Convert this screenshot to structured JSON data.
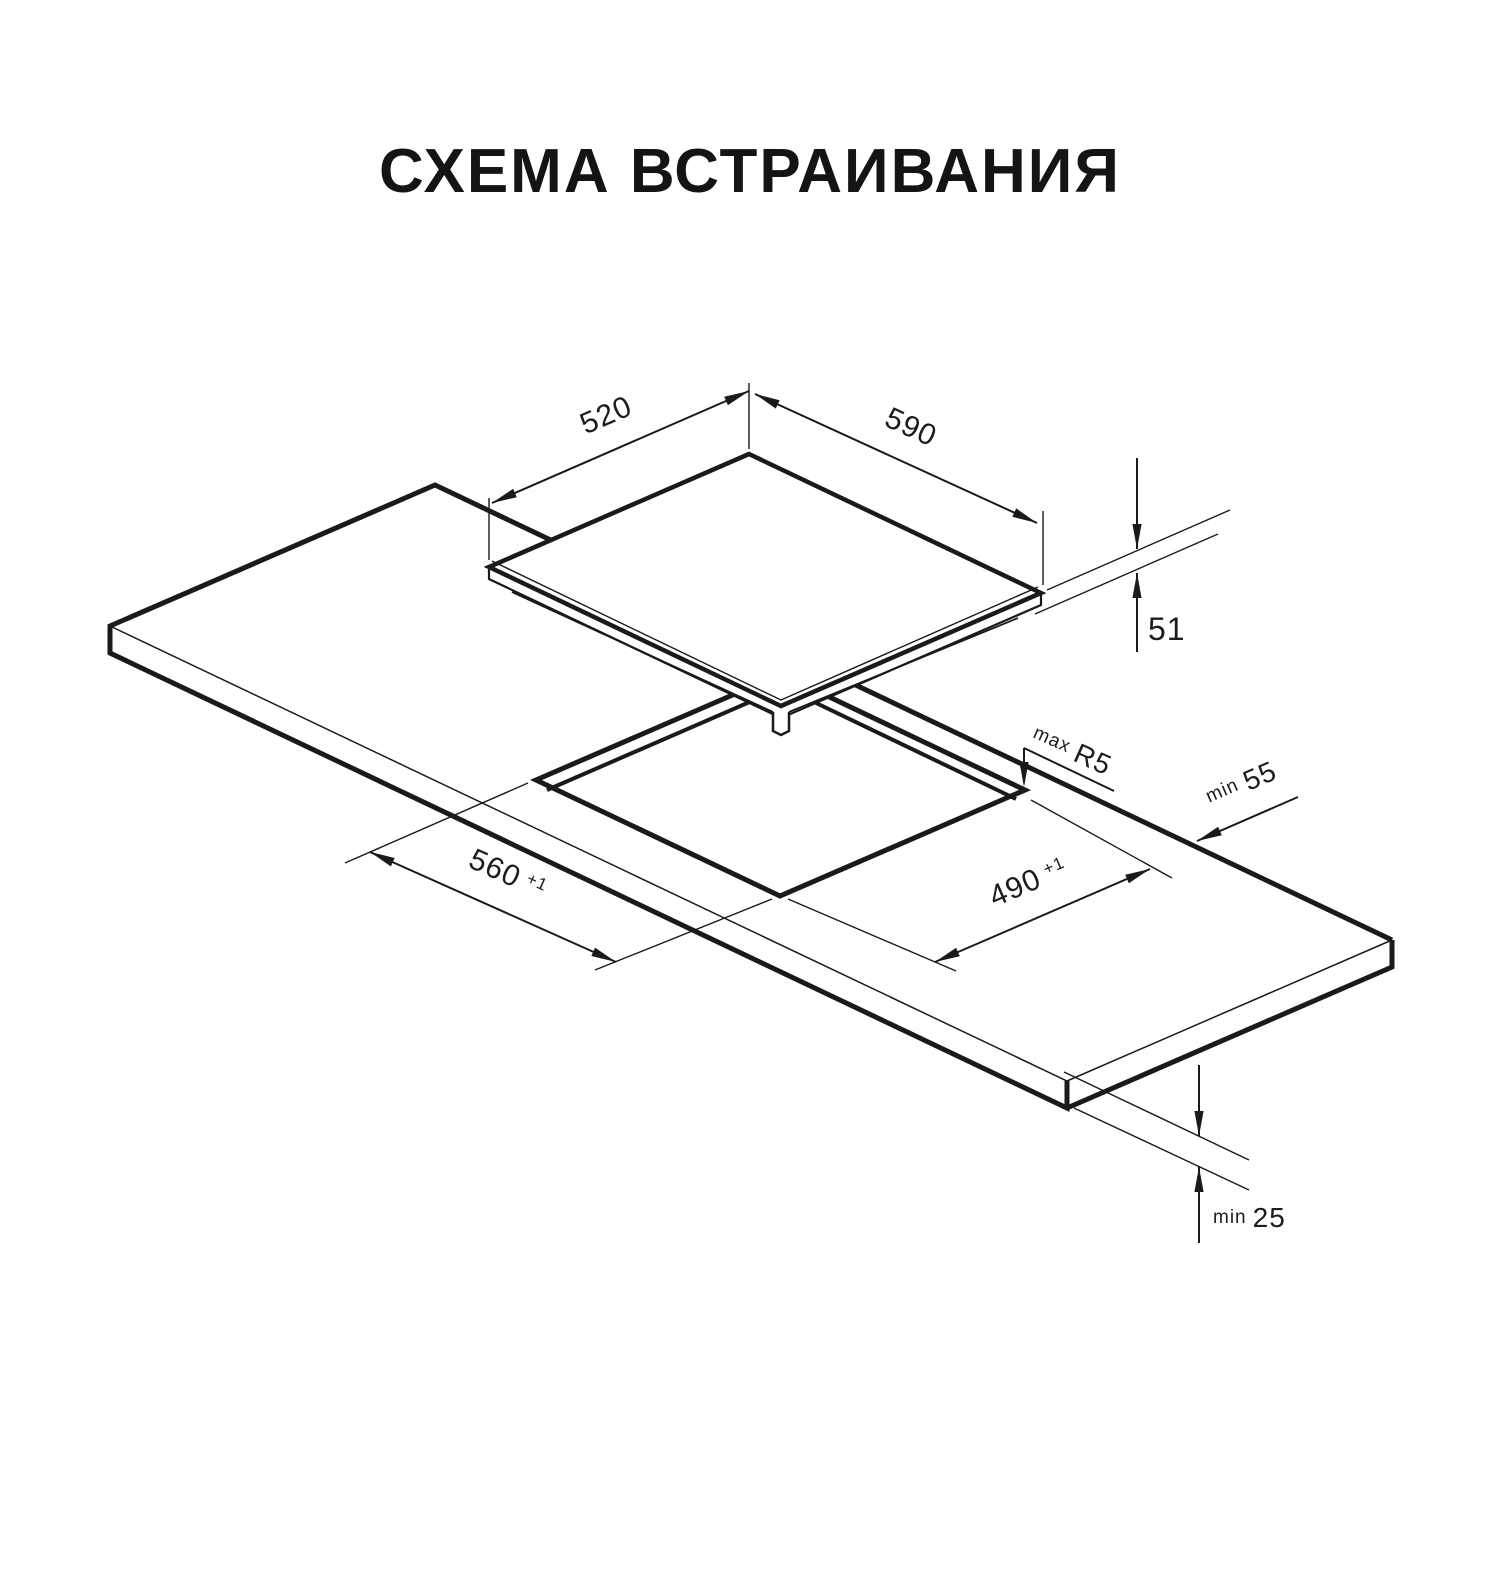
{
  "title": "СХЕМА ВСТРАИВАНИЯ",
  "diagram": {
    "colors": {
      "line": "#1a1a1a",
      "background": "#ffffff"
    },
    "dimensions": [
      {
        "name": "hob-depth",
        "value": "520"
      },
      {
        "name": "hob-width",
        "value": "590"
      },
      {
        "name": "hob-height",
        "value": "51"
      },
      {
        "name": "cutout-corner-radius",
        "prefix": "max",
        "value": "R5"
      },
      {
        "name": "rear-edge-clearance",
        "prefix": "min",
        "value": "55"
      },
      {
        "name": "cutout-width",
        "value": "560",
        "tolerance": "+1"
      },
      {
        "name": "cutout-depth",
        "value": "490",
        "tolerance": "+1"
      },
      {
        "name": "bottom-clearance",
        "prefix": "min",
        "value": "25"
      }
    ]
  }
}
